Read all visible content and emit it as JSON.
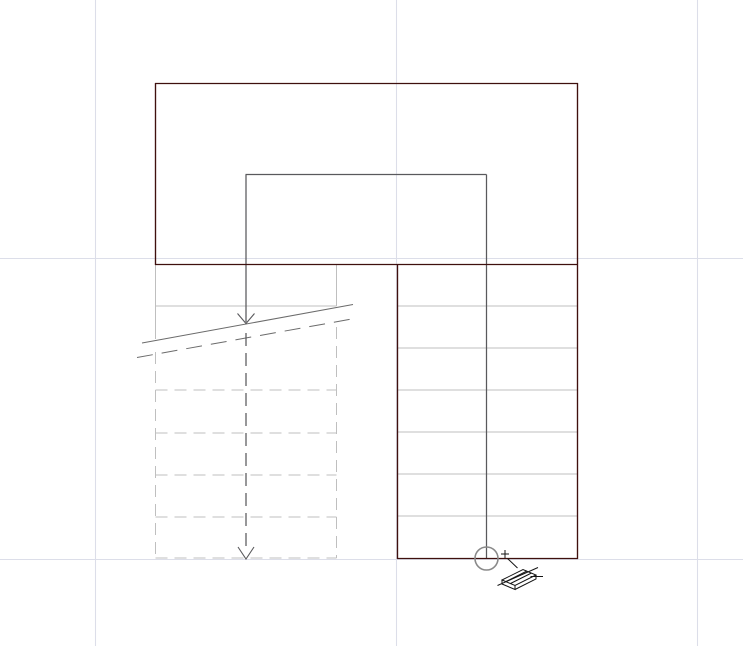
{
  "app": {
    "view_name": "stair-plan-view-canvas",
    "description": "CAD viewport showing a U-shaped stair plan during run placement"
  },
  "canvas": {
    "width": 743,
    "height": 646,
    "background": "#ffffff"
  },
  "colors": {
    "grid": "#dcdee9",
    "boundary": "#3f100e",
    "tread": "#bfbfbf",
    "walk": "#59595c",
    "break_line": "#6b6b6b",
    "snap": "#8a8a8a",
    "cursor": "#141414"
  },
  "icons": {
    "snap_circle": "stair-run-endpoint-snap-circle",
    "crosshair": "placement-crosshair-cursor",
    "run_badge": "stair-run-tool-badge"
  },
  "drawing": {
    "layers": [
      {
        "name": "grid-lines",
        "stroke": "grid",
        "width": 1.1,
        "lines": [
          [
            95.5,
            0,
            95.5,
            646
          ],
          [
            396.5,
            0,
            396.5,
            646
          ],
          [
            697.5,
            0,
            697.5,
            646
          ],
          [
            0,
            258.5,
            743,
            258.5
          ],
          [
            0,
            559.5,
            743,
            559.5
          ]
        ]
      },
      {
        "name": "right-run-treads",
        "stroke": "tread",
        "width": 1,
        "lines": [
          [
            398,
            306,
            577,
            306
          ],
          [
            398,
            348,
            577,
            348
          ],
          [
            398,
            390,
            577,
            390
          ],
          [
            398,
            432,
            577,
            432
          ],
          [
            398,
            474,
            577,
            474
          ],
          [
            398,
            516,
            577,
            516
          ]
        ]
      },
      {
        "name": "left-run-solid-lines",
        "stroke": "tread",
        "width": 1,
        "lines": [
          [
            155.5,
            265,
            155.5,
            339
          ],
          [
            336.5,
            265,
            336.5,
            306
          ],
          [
            155.5,
            306,
            336.5,
            306
          ]
        ]
      },
      {
        "name": "left-run-dashed-lines",
        "stroke": "tread",
        "width": 1,
        "dash": "12 7",
        "lines": [
          [
            155.5,
            352,
            155.5,
            558
          ],
          [
            336.5,
            327,
            336.5,
            558
          ],
          [
            155.5,
            390,
            336.5,
            390
          ],
          [
            155.5,
            433,
            336.5,
            433
          ],
          [
            155.5,
            475,
            336.5,
            475
          ],
          [
            155.5,
            517,
            336.5,
            517
          ],
          [
            155.5,
            558,
            336.5,
            558
          ]
        ]
      },
      {
        "name": "break-line-solid",
        "stroke": "break_line",
        "width": 1,
        "lines": [
          [
            142,
            343,
            353,
            304.5
          ]
        ]
      },
      {
        "name": "break-line-dashed",
        "stroke": "break_line",
        "width": 1,
        "dash": "16 9",
        "lines": [
          [
            137,
            357.5,
            352,
            319
          ]
        ]
      },
      {
        "name": "walk-line-solid",
        "stroke": "walk",
        "width": 1.25,
        "lines": [
          [
            246,
            174.5,
            246,
            322
          ],
          [
            245.5,
            174.5,
            486.5,
            174.5
          ],
          [
            486.5,
            174.5,
            486.5,
            558
          ]
        ]
      },
      {
        "name": "walk-line-dashed",
        "stroke": "walk",
        "width": 1.25,
        "dash": "13 7",
        "lines": [
          [
            246,
            333,
            246,
            548
          ]
        ]
      },
      {
        "name": "stair-boundary",
        "stroke": "boundary",
        "width": 1.35,
        "lines": [
          [
            155,
            83.5,
            578,
            83.5
          ],
          [
            155.5,
            83,
            155.5,
            265
          ],
          [
            577.5,
            83,
            577.5,
            559
          ],
          [
            155,
            264.5,
            578,
            264.5
          ],
          [
            397.5,
            264,
            397.5,
            559
          ],
          [
            397,
            558.5,
            578,
            558.5
          ]
        ]
      },
      {
        "name": "walk-direction-arrows",
        "stroke": "walk",
        "width": 1.1,
        "polylines": [
          [
            [
              237.5,
              313.5
            ],
            [
              246,
              323.5
            ],
            [
              254.5,
              313.5
            ]
          ],
          [
            [
              238,
              547
            ],
            [
              246,
              559
            ],
            [
              254,
              547
            ]
          ]
        ]
      },
      {
        "name": "snap-circle-icon",
        "stroke": "snap",
        "width": 1.6,
        "circles": [
          {
            "cx": 486.5,
            "cy": 558.5,
            "r": 11.5
          }
        ]
      },
      {
        "name": "crosshair-icon",
        "stroke": "cursor",
        "width": 1,
        "lines": [
          [
            501,
            554,
            509,
            554
          ],
          [
            505,
            550,
            505,
            558
          ],
          [
            507.5,
            558.5,
            517.5,
            568
          ]
        ]
      },
      {
        "name": "stair-run-badge-icon",
        "stroke": "cursor",
        "width": 1,
        "paths": [
          "M502,580 L523,569.5 L536,575 L515,585.5 Z",
          "M502,580 L502,584 L515,589.5 L515,585.5",
          "M515,589.5 L536,579 L536,575",
          "M506,581.5 L527,571",
          "M510.5,583.5 L531.5,573",
          "M497.5,585.5 L538,567.5",
          "M530.5,576.5 L543,576.5"
        ]
      }
    ]
  }
}
